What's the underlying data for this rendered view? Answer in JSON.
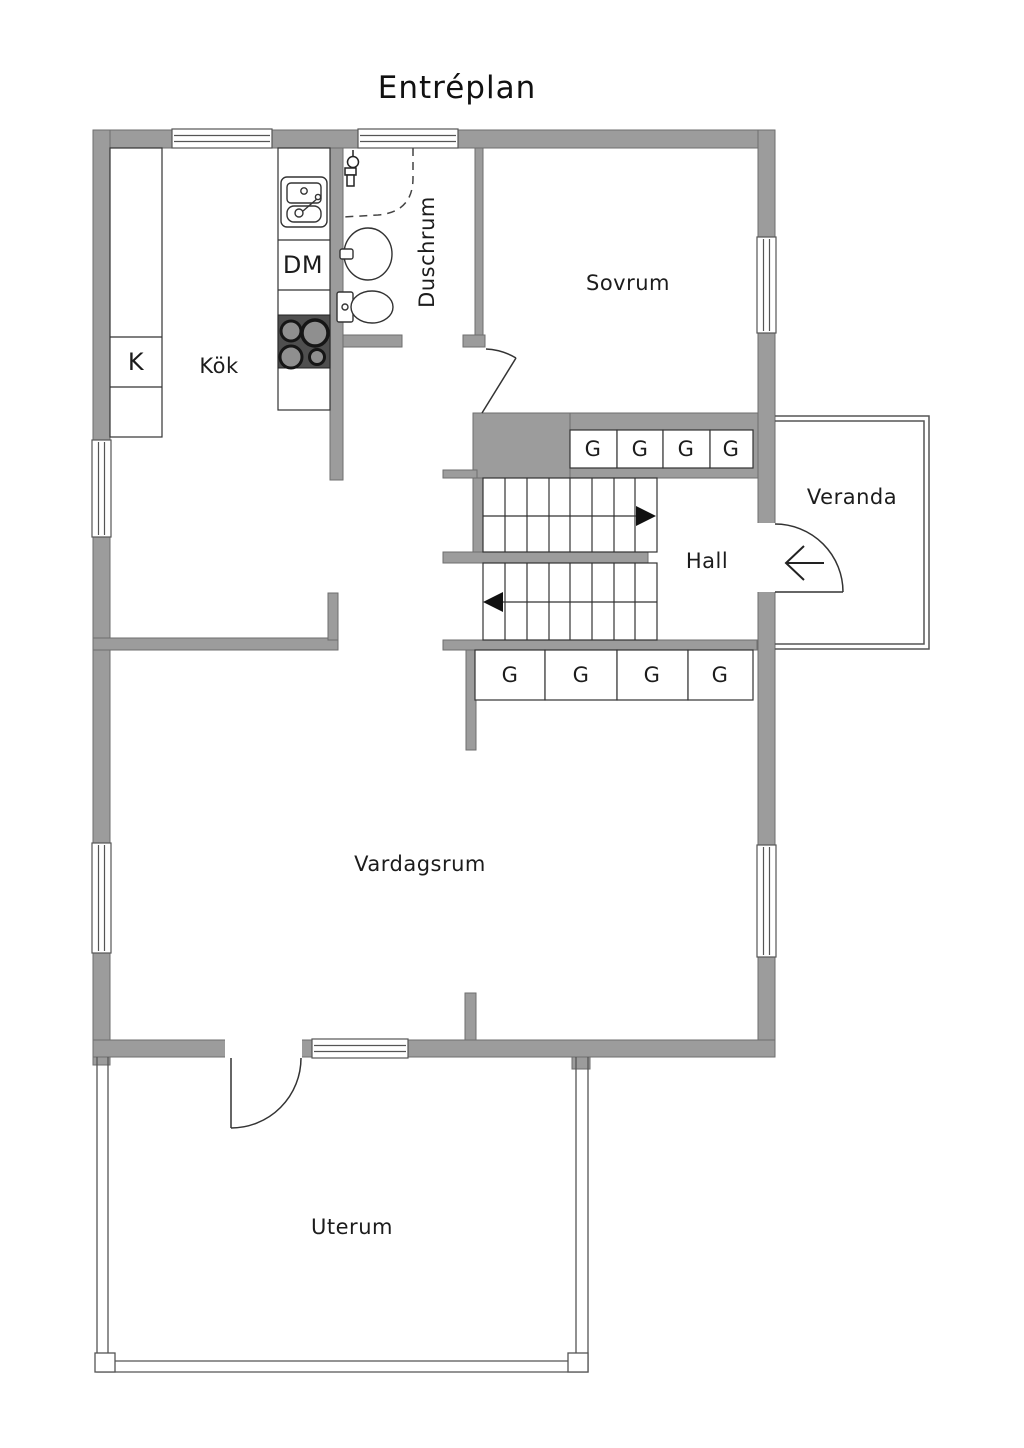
{
  "title": "Entréplan",
  "rooms": {
    "kitchen": {
      "label": "Kök"
    },
    "shower_room": {
      "label": "Duschrum"
    },
    "bedroom": {
      "label": "Sovrum"
    },
    "hall": {
      "label": "Hall"
    },
    "veranda": {
      "label": "Veranda"
    },
    "living_room": {
      "label": "Vardagsrum"
    },
    "conservatory": {
      "label": "Uterum"
    }
  },
  "appliances": {
    "fridge": "K",
    "dishwasher": "DM"
  },
  "closets": {
    "upper": [
      "G",
      "G",
      "G",
      "G"
    ],
    "lower": [
      "G",
      "G",
      "G",
      "G"
    ]
  },
  "colors": {
    "wall": "#9c9c9c",
    "wall_outline": "#6e6e6e",
    "thin_line": "#333333",
    "stove": "#4f4f4f",
    "burner_ring": "#161616",
    "burner_fill": "#8f8f8f"
  }
}
